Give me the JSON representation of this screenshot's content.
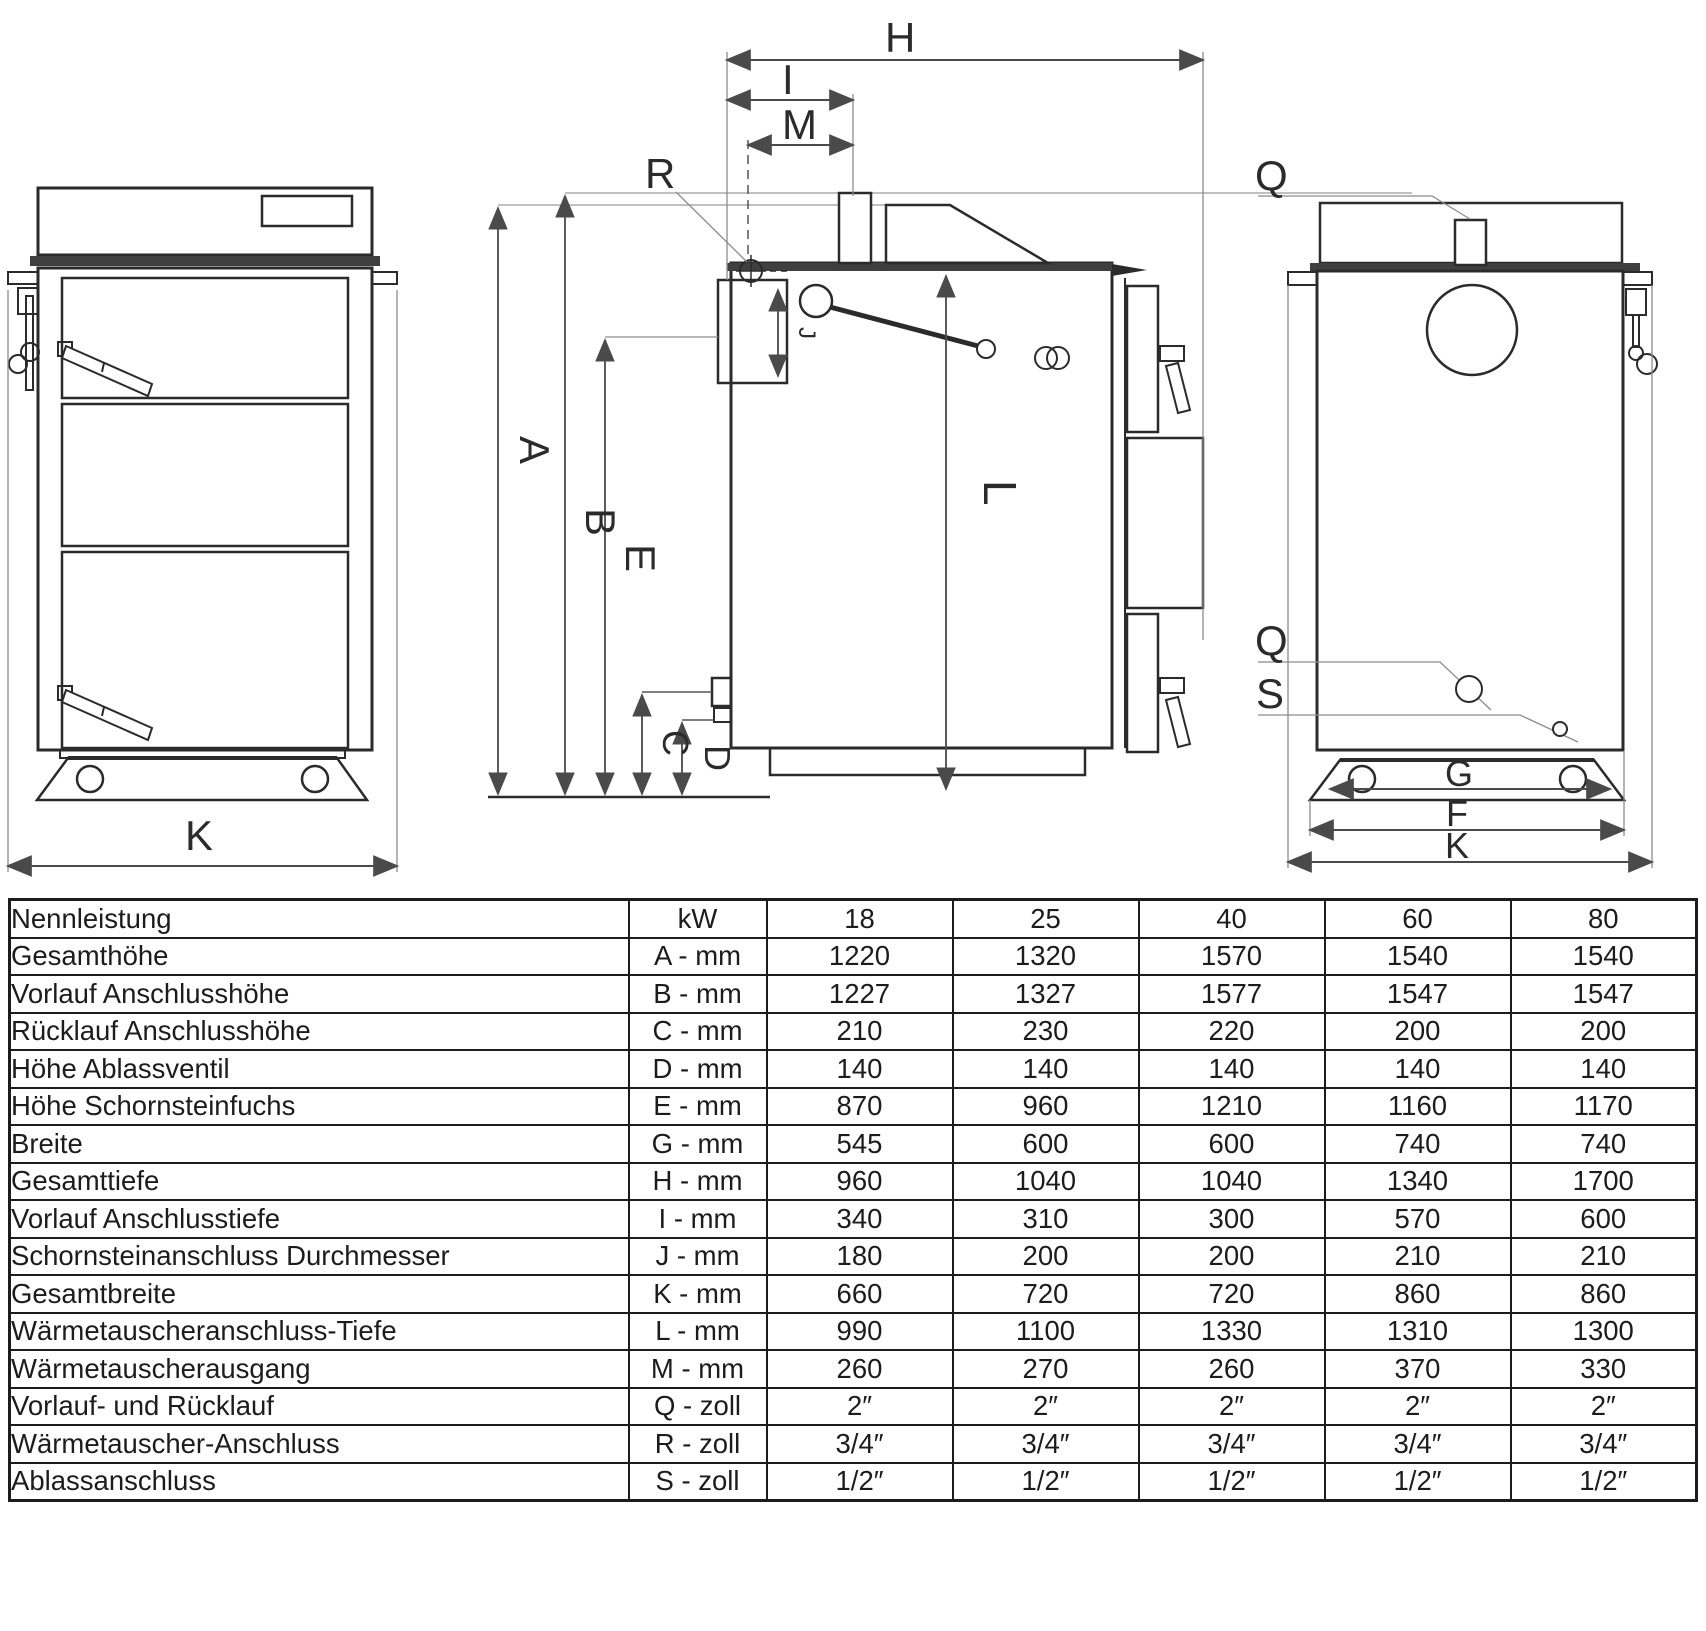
{
  "drawing": {
    "dimension_labels": {
      "A": "A",
      "B": "B",
      "C": "C",
      "D": "D",
      "E": "E",
      "F": "F",
      "G": "G",
      "H": "H",
      "I": "I",
      "J": "J",
      "K": "K",
      "L": "L",
      "M": "M",
      "Q": "Q",
      "R": "R",
      "S": "S"
    },
    "colors": {
      "outline": "#2b2b2b",
      "dimension": "#4a4a4a",
      "reference": "#8c8c8c",
      "band": "#3f3f3f"
    }
  },
  "table": {
    "header": {
      "label": "Nennleistung",
      "unit": "kW",
      "values": [
        "18",
        "25",
        "40",
        "60",
        "80"
      ]
    },
    "rows": [
      {
        "label": "Gesamthöhe",
        "unit": "A - mm",
        "values": [
          "1220",
          "1320",
          "1570",
          "1540",
          "1540"
        ]
      },
      {
        "label": "Vorlauf Anschlusshöhe",
        "unit": "B - mm",
        "values": [
          "1227",
          "1327",
          "1577",
          "1547",
          "1547"
        ]
      },
      {
        "label": "Rücklauf Anschlusshöhe",
        "unit": "C - mm",
        "values": [
          "210",
          "230",
          "220",
          "200",
          "200"
        ]
      },
      {
        "label": "Höhe Ablassventil",
        "unit": "D - mm",
        "values": [
          "140",
          "140",
          "140",
          "140",
          "140"
        ]
      },
      {
        "label": "Höhe Schornsteinfuchs",
        "unit": "E - mm",
        "values": [
          "870",
          "960",
          "1210",
          "1160",
          "1170"
        ]
      },
      {
        "label": "Breite",
        "unit": "G - mm",
        "values": [
          "545",
          "600",
          "600",
          "740",
          "740"
        ]
      },
      {
        "label": "Gesamttiefe",
        "unit": "H - mm",
        "values": [
          "960",
          "1040",
          "1040",
          "1340",
          "1700"
        ]
      },
      {
        "label": "Vorlauf Anschlusstiefe",
        "unit": "I - mm",
        "values": [
          "340",
          "310",
          "300",
          "570",
          "600"
        ]
      },
      {
        "label": "Schornsteinanschluss Durchmesser",
        "unit": "J - mm",
        "values": [
          "180",
          "200",
          "200",
          "210",
          "210"
        ]
      },
      {
        "label": "Gesamtbreite",
        "unit": "K - mm",
        "values": [
          "660",
          "720",
          "720",
          "860",
          "860"
        ]
      },
      {
        "label": "Wärmetauscheranschluss-Tiefe",
        "unit": "L - mm",
        "values": [
          "990",
          "1100",
          "1330",
          "1310",
          "1300"
        ]
      },
      {
        "label": "Wärmetauscherausgang",
        "unit": "M - mm",
        "values": [
          "260",
          "270",
          "260",
          "370",
          "330"
        ]
      },
      {
        "label": "Vorlauf- und Rücklauf",
        "unit": "Q - zoll",
        "values": [
          "2″",
          "2″",
          "2″",
          "2″",
          "2″"
        ]
      },
      {
        "label": "Wärmetauscher-Anschluss",
        "unit": "R - zoll",
        "values": [
          "3/4″",
          "3/4″",
          "3/4″",
          "3/4″",
          "3/4″"
        ]
      },
      {
        "label": "Ablassanschluss",
        "unit": "S - zoll",
        "values": [
          "1/2″",
          "1/2″",
          "1/2″",
          "1/2″",
          "1/2″"
        ]
      }
    ]
  }
}
